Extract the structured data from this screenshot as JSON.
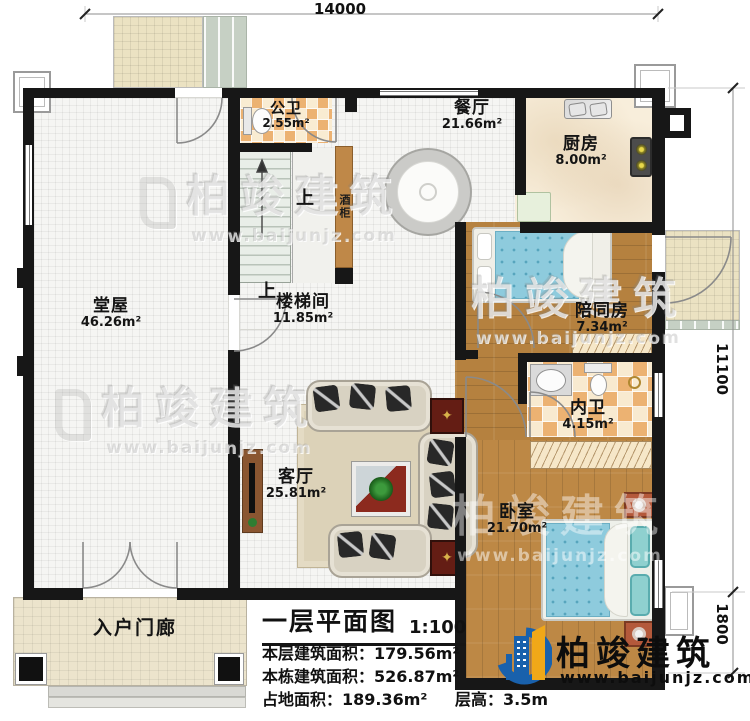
{
  "dimensions": {
    "top": "14000",
    "right_upper": "11100",
    "right_lower": "1800"
  },
  "rooms": {
    "gongwei": {
      "name": "公卫",
      "area": "2.55m²"
    },
    "canting": {
      "name": "餐厅",
      "area": "21.66m²"
    },
    "chufang": {
      "name": "厨房",
      "area": "8.00m²"
    },
    "tangwu": {
      "name": "堂屋",
      "area": "46.26m²"
    },
    "loutijian": {
      "name": "楼梯间",
      "area": "11.85m²"
    },
    "peitongfang": {
      "name": "陪同房",
      "area": "7.34m²"
    },
    "neiwei": {
      "name": "内卫",
      "area": "4.15m²"
    },
    "keting": {
      "name": "客厅",
      "area": "25.81m²"
    },
    "woshi": {
      "name": "卧室",
      "area": "21.70m²"
    },
    "menlang": {
      "name": "入户门廊"
    }
  },
  "annotations": {
    "up": "上",
    "wine_cabinet": "酒柜"
  },
  "title_block": {
    "title": "一层平面图",
    "scale": "1:100",
    "floor_area": "本层建筑面积：179.56m²",
    "building_area": "本栋建筑面积：526.87m²",
    "land_area": "占地面积：189.36m²",
    "floor_height": "层高：3.5m"
  },
  "brand": {
    "name": "柏竣建筑",
    "site": "www.baijunjz.com"
  },
  "watermark": {
    "name": "柏竣建筑",
    "site": "www.baijunjz.com"
  },
  "colors": {
    "wall": "#171717",
    "wood": "#b5813f",
    "tile_accent": "#ecb272",
    "bed_blue": "#8ecbdd",
    "brand_blue": "#1961ac",
    "brand_yellow": "#f0a818"
  }
}
